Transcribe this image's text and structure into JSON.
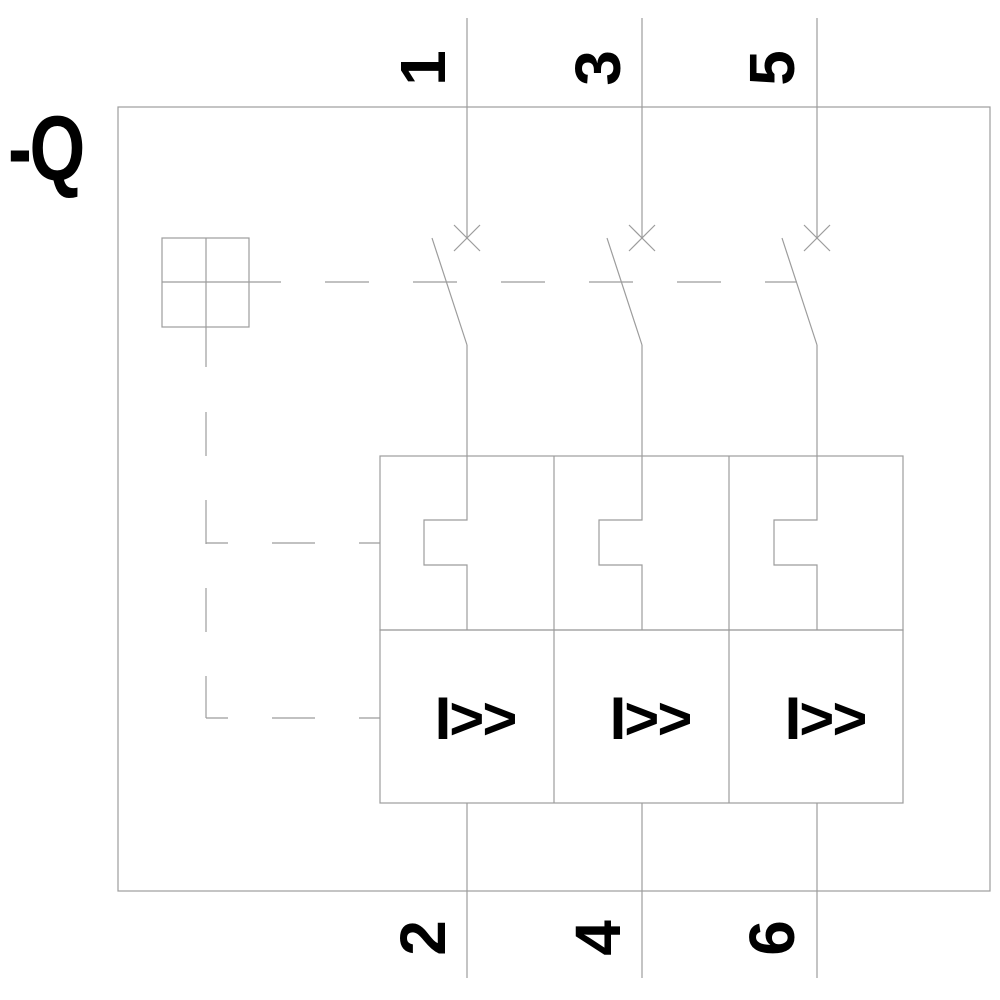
{
  "schematic": {
    "device_label": "-Q",
    "top_terminals": [
      "1",
      "3",
      "5"
    ],
    "bottom_terminals": [
      "2",
      "4",
      "6"
    ],
    "magnetic_trip_labels": [
      "I>>",
      "I>>",
      "I>>"
    ],
    "colors": {
      "background": "#ffffff",
      "line": "#9c9c9c",
      "text": "#000000"
    }
  }
}
